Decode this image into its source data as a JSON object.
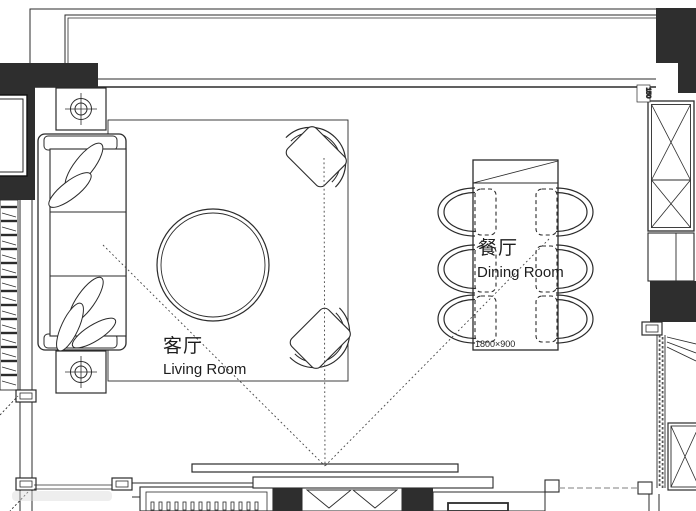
{
  "plan": {
    "living_room": {
      "name_zh": "客厅",
      "name_en": "Living Room"
    },
    "dining_room": {
      "name_zh": "餐厅",
      "name_en": "Dining Room",
      "table_dimension": "1800×900"
    },
    "dimensions": {
      "right_wall_thickness": "150"
    }
  },
  "colors": {
    "wall_fill": "#2e2e2e",
    "line": "#2b2b2b",
    "text": "#1d1d1d",
    "gray_dashed": "#999999",
    "background": "#ffffff"
  }
}
